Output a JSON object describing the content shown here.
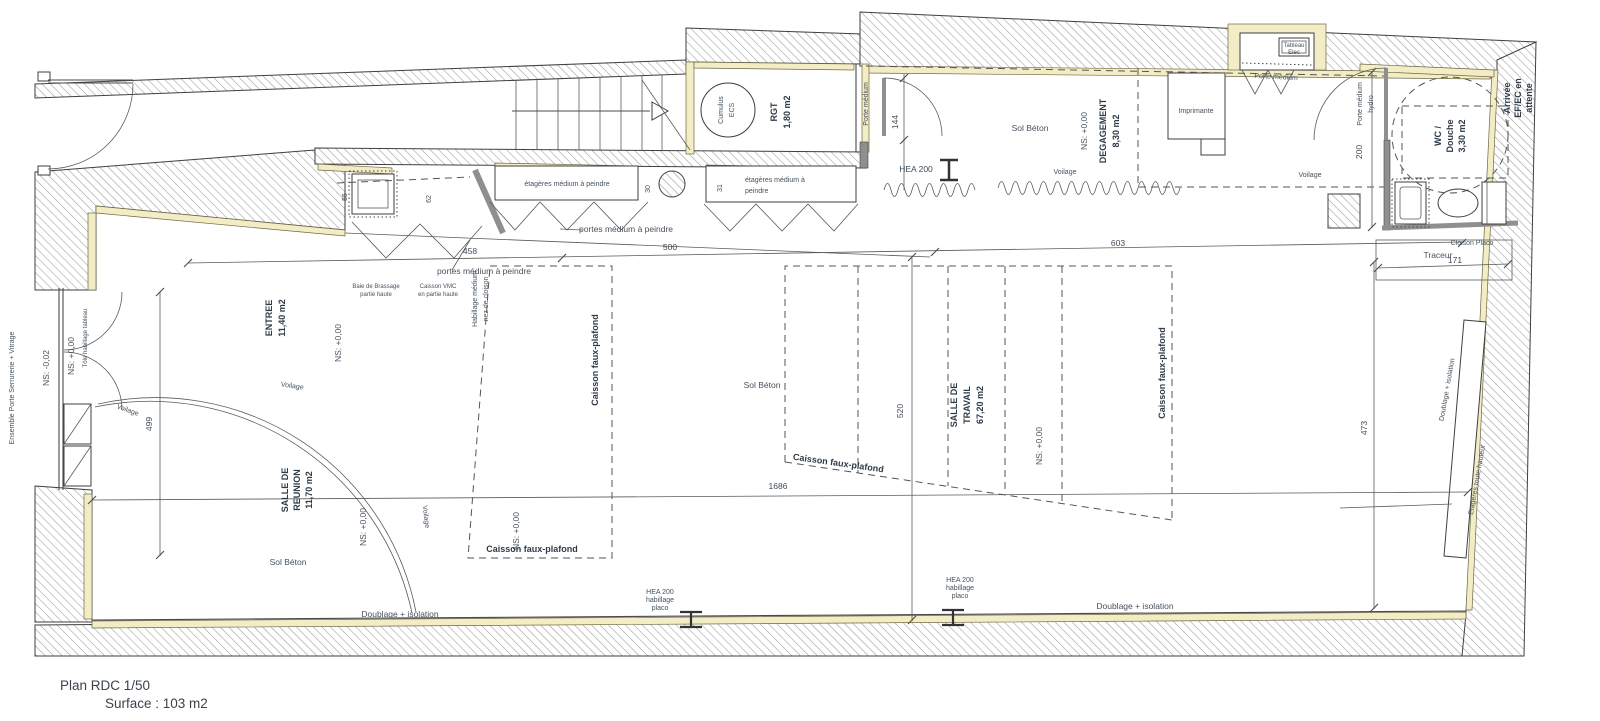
{
  "title": {
    "plan": "Plan RDC 1/50",
    "surface": "Surface : 103 m2"
  },
  "rooms": {
    "entree": {
      "name": "ENTREE",
      "area": "11,40 m2"
    },
    "reunion": {
      "l1": "SALLE DE",
      "l2": "REUNION",
      "area": "11,70 m2"
    },
    "travail": {
      "l1": "SALLE DE",
      "l2": "TRAVAIL",
      "area": "67,20 m2"
    },
    "rgt": {
      "name": "RGT",
      "area": "1,80 m2"
    },
    "degagement": {
      "name": "DEGAGEMENT",
      "area": "8,30 m2"
    },
    "wc": {
      "l1": "WC /",
      "l2": "Douche",
      "area": "3,30 m2"
    }
  },
  "levels": {
    "ns0": "NS: +0,00",
    "nsm2": "NS: -0,02"
  },
  "equipment": {
    "cumulus_l1": "Cumulus",
    "cumulus_l2": "ECS",
    "tableau_l1": "Tableau",
    "tableau_l2": "Elec",
    "imprimante": "Imprimante",
    "traceur": "Traceur"
  },
  "annotations": {
    "ensemble_porte": "Ensemble Porte Serrurerie + Vitrage",
    "tole": "Tôle habillage tableau",
    "sol_beton": "Sol Béton",
    "voilage": "Voilage",
    "porte_medium": "Porte médium",
    "hydro": "hydro",
    "etageres_1l": "étagères médium à peindre",
    "etageres_l1": "étagères médium à",
    "etageres_l2": "peindre",
    "portes_medium": "portes médium à peindre",
    "baie_l1": "Baie de Brassage",
    "baie_l2": "partie haute",
    "vmc_l1": "Caisson VMC",
    "vmc_l2": "en partie haute",
    "habillage_l1": "Habillage médium",
    "habillage_l2": "nez de cloison",
    "caisson_fp": "Caisson faux-plafond",
    "cloison_placo": "Cloison Placo",
    "doublage": "Doublage + isolation",
    "etageres_th": "Etagères toute hauteur",
    "hea200": "HEA 200",
    "habillage": "habillage",
    "placo": "placo",
    "arrivee_l1": "Arrivée",
    "arrivee_l2": "EF/EC en",
    "arrivee_l3": "attente"
  },
  "dimensions": {
    "d458": "458",
    "d500": "500",
    "d603": "603",
    "d1686": "1686",
    "d499": "499",
    "d520": "520",
    "d473": "473",
    "d200": "200",
    "d144": "144",
    "d171": "171",
    "d55": "55",
    "d62": "62",
    "d30": "30",
    "d31": "31"
  },
  "colors": {
    "insulation": "#f2edc4",
    "wall_hatch": "#9a9a9a",
    "line": "#4b4b4b",
    "text": "#46525e"
  }
}
